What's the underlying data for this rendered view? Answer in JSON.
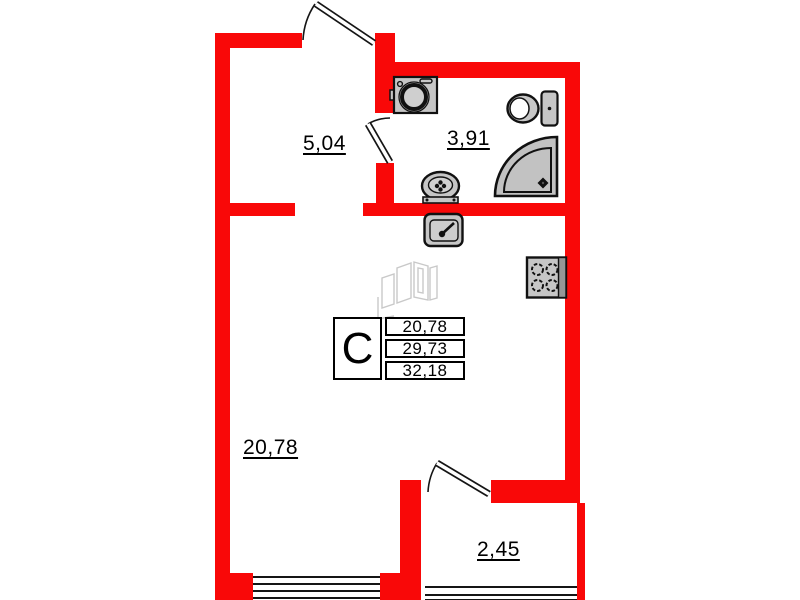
{
  "canvas": {
    "width": 800,
    "height": 600
  },
  "colors": {
    "wall_red": "#f90808",
    "fixture_fill": "#c6c6c6",
    "fixture_stroke": "#111111",
    "window_line": "#151515",
    "pictogram_gray": "#c9c9c9",
    "text": "#000000",
    "background": "#ffffff"
  },
  "info_box": {
    "type_label": "С",
    "rows": [
      "20,78",
      "29,73",
      "32,18"
    ]
  },
  "labels": {
    "hallway": "5,04",
    "bathroom": "3,91",
    "living_room": "20,78",
    "balcony": "2,45"
  },
  "icons": {
    "fixtures": [
      "washing-machine-icon",
      "toilet-icon",
      "corner-shower-icon",
      "bathroom-sink-icon",
      "kitchen-sink-icon",
      "stove-icon",
      "unit-3d-pictogram-icon"
    ],
    "doors": [
      "entrance-door-swing",
      "bathroom-door-swing",
      "balcony-door-swing"
    ]
  }
}
